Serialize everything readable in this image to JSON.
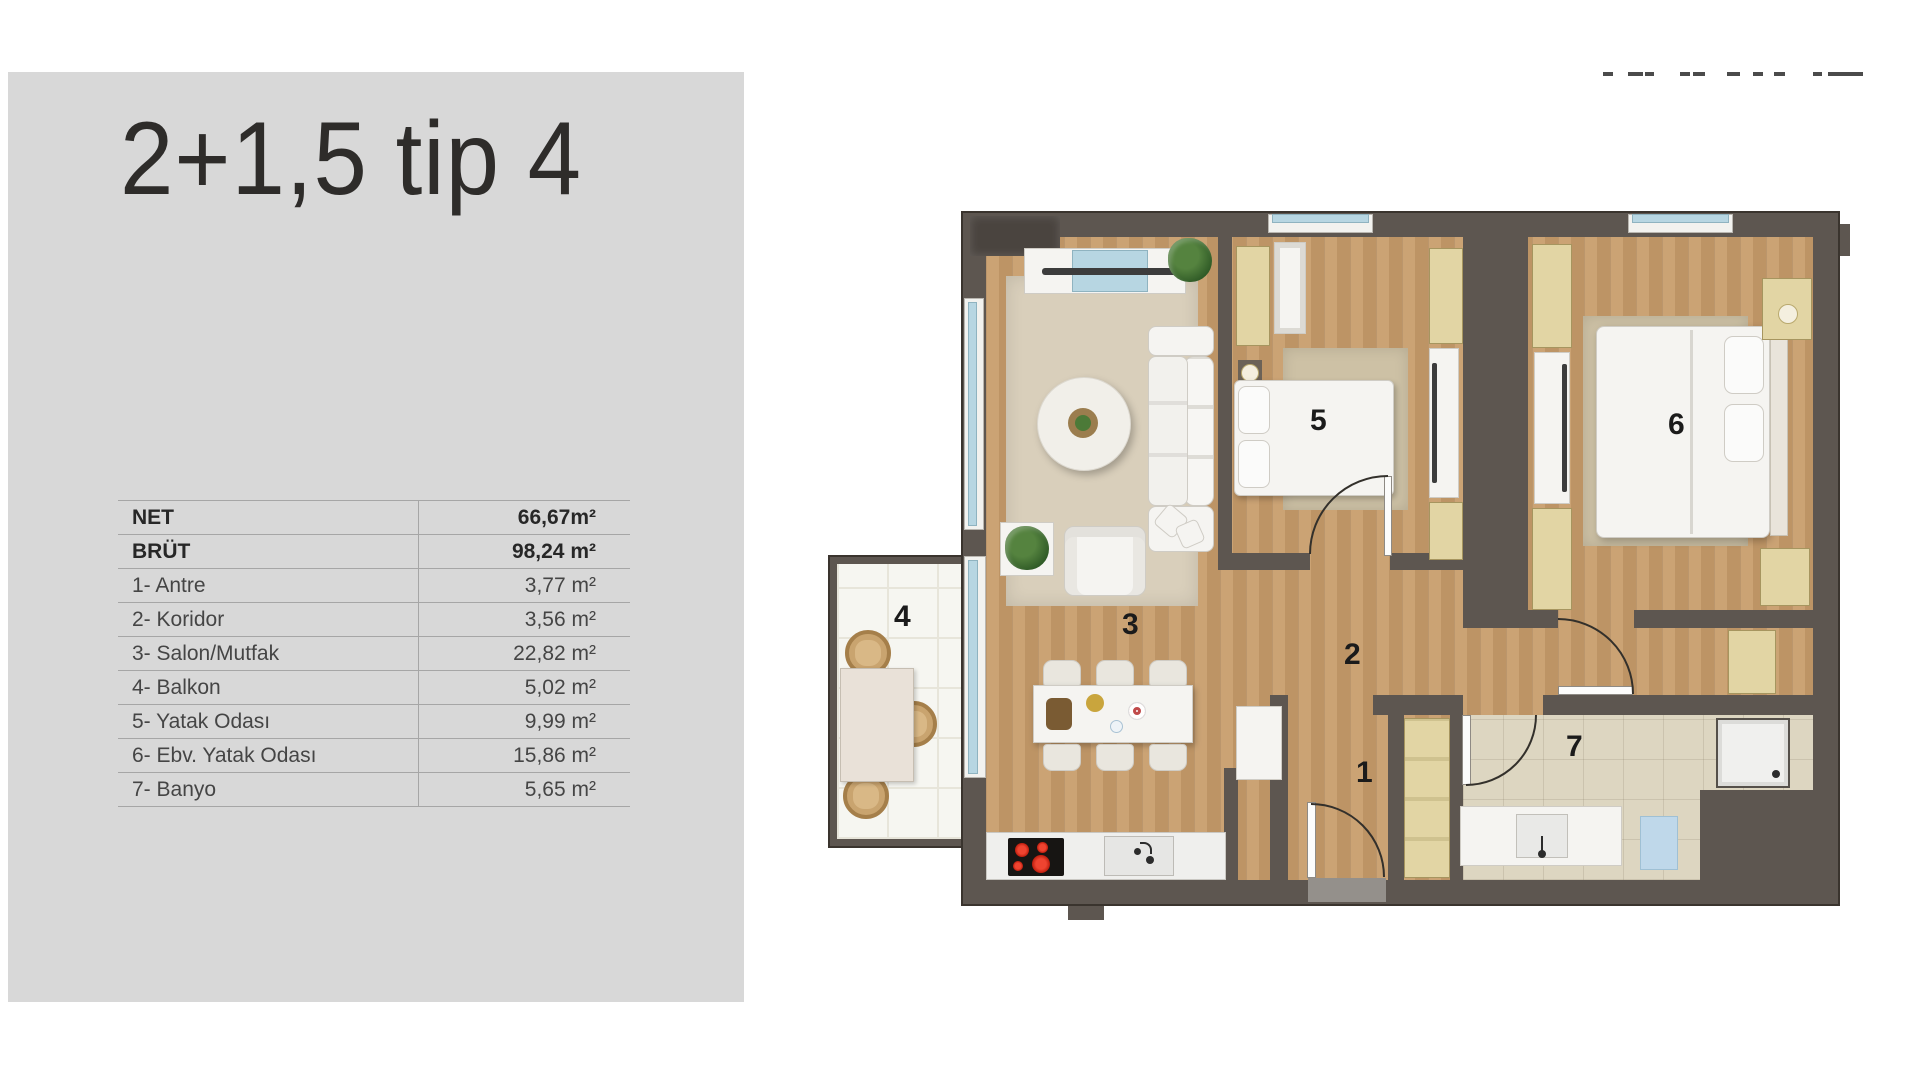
{
  "panel": {
    "title": "2+1,5 tip 4",
    "table": {
      "rows": [
        {
          "label": "NET",
          "value": "66,67m²",
          "bold": true
        },
        {
          "label": "BRÜT",
          "value": "98,24 m²",
          "bold": true
        },
        {
          "label": "1- Antre",
          "value": "3,77 m²",
          "bold": false
        },
        {
          "label": "2- Koridor",
          "value": "3,56 m²",
          "bold": false
        },
        {
          "label": "3- Salon/Mutfak",
          "value": "22,82 m²",
          "bold": false
        },
        {
          "label": "4- Balkon",
          "value": "5,02 m²",
          "bold": false
        },
        {
          "label": "5- Yatak Odası",
          "value": "9,99 m²",
          "bold": false
        },
        {
          "label": "6- Ebv. Yatak Odası",
          "value": "15,86 m²",
          "bold": false
        },
        {
          "label": "7- Banyo",
          "value": "5,65 m²",
          "bold": false
        }
      ]
    }
  },
  "logo_fragment": {
    "dashes": [
      {
        "x": 5,
        "w": 10
      },
      {
        "x": 30,
        "w": 15
      },
      {
        "x": 47,
        "w": 9
      },
      {
        "x": 82,
        "w": 10
      },
      {
        "x": 95,
        "w": 12
      },
      {
        "x": 129,
        "w": 13
      },
      {
        "x": 155,
        "w": 10
      },
      {
        "x": 176,
        "w": 11
      },
      {
        "x": 215,
        "w": 9
      },
      {
        "x": 230,
        "w": 35
      }
    ]
  },
  "floorplan": {
    "room_labels": [
      {
        "num": "1",
        "x": 528,
        "y": 548
      },
      {
        "num": "2",
        "x": 516,
        "y": 430
      },
      {
        "num": "3",
        "x": 294,
        "y": 400
      },
      {
        "num": "4",
        "x": 66,
        "y": 392
      },
      {
        "num": "5",
        "x": 482,
        "y": 196
      },
      {
        "num": "6",
        "x": 840,
        "y": 200
      },
      {
        "num": "7",
        "x": 738,
        "y": 522
      }
    ]
  },
  "colors": {
    "wall": "#5d5650",
    "wallDark": "#3a342e",
    "wood": "#c79c6a",
    "rug": "#d9cfbb",
    "rugTan": "#cdc1a5",
    "tan": "#e2d5a4",
    "tanLine": "#a6955f",
    "white": "#f5f4f1",
    "whiteLine": "#cfccc5",
    "blue": "#b7d6e2",
    "glassLine": "#8fb3c0",
    "tile": "#ddd6c1",
    "balcTile": "#f6f6f1",
    "gridLine": "#e7e5da",
    "red": "#d82a1b",
    "cook": "#171513",
    "mat": "#bfd8ea",
    "sill": "#94908b",
    "panel": "#d8d8d8",
    "line": "#a6a6a6",
    "text": "#454545",
    "bold": "#272727",
    "label": "#1b1b1b",
    "wick": "#c9a46f",
    "arc": "#33302b"
  }
}
